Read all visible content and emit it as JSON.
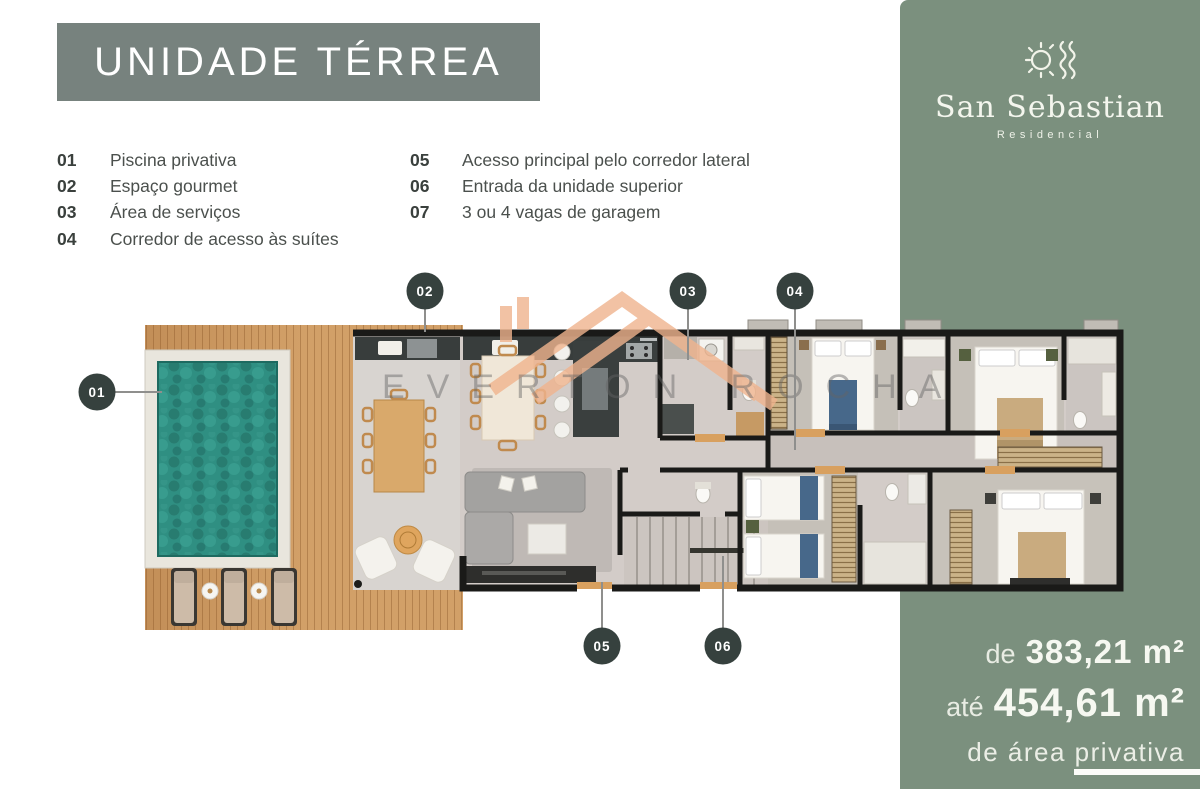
{
  "theme": {
    "green": "#7b907e",
    "slate": "#77827e",
    "dark": "#36413e",
    "ink": "#3a403d",
    "label": "#4b504d",
    "wood": "#d2a068",
    "pool": "#2f8f82",
    "roof": "#f0b48e",
    "floor": "#d3ccc8",
    "wall": "#1a1a18"
  },
  "title_banner": {
    "text": "UNIDADE TÉRREA"
  },
  "legend": {
    "columns": [
      {
        "items": [
          {
            "num": "01",
            "label": "Piscina privativa"
          },
          {
            "num": "02",
            "label": "Espaço gourmet"
          },
          {
            "num": "03",
            "label": "Área de serviços"
          },
          {
            "num": "04",
            "label": "Corredor de acesso às suítes"
          }
        ]
      },
      {
        "items": [
          {
            "num": "05",
            "label": "Acesso principal pelo corredor lateral"
          },
          {
            "num": "06",
            "label": "Entrada da unidade superior"
          },
          {
            "num": "07",
            "label": "3 ou 4 vagas de garagem"
          }
        ]
      }
    ]
  },
  "brand_panel": {
    "logo": {
      "icon": "sun-waves-icon",
      "name": "San Sebastian",
      "subtitle": "Residencial"
    },
    "area": {
      "from_prefix": "de",
      "from_value": "383,21 m²",
      "to_prefix": "até",
      "to_value": "454,61 m²",
      "suffix": "de área privativa"
    }
  },
  "watermark": {
    "text": "EVERTON ROCHA",
    "icon": "roof-logo-icon"
  },
  "plan": {
    "markers": [
      {
        "label": "01"
      },
      {
        "label": "02"
      },
      {
        "label": "03"
      },
      {
        "label": "04"
      },
      {
        "label": "05"
      },
      {
        "label": "06"
      }
    ]
  }
}
